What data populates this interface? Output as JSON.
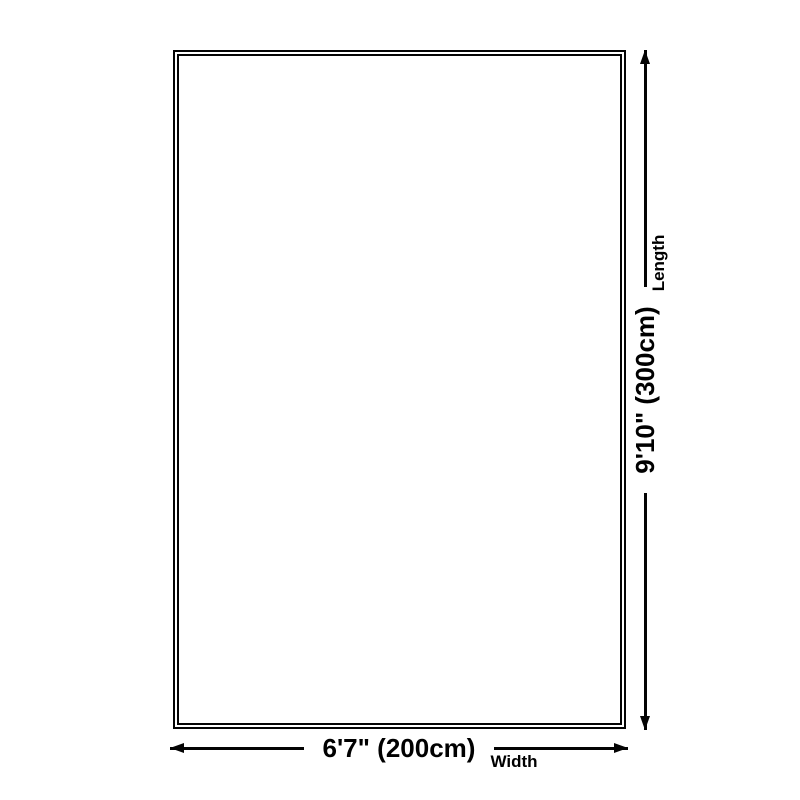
{
  "diagram": {
    "type": "product-dimension-diagram",
    "shape": "rectangle"
  },
  "dimensions": {
    "width": {
      "value": "6'7\" (200cm)",
      "caption": "Width"
    },
    "length": {
      "value": "9'10\" (300cm)",
      "caption": "Length"
    }
  },
  "colors": {
    "line": "#040404",
    "text": "#000000",
    "background": "#ffffff"
  }
}
